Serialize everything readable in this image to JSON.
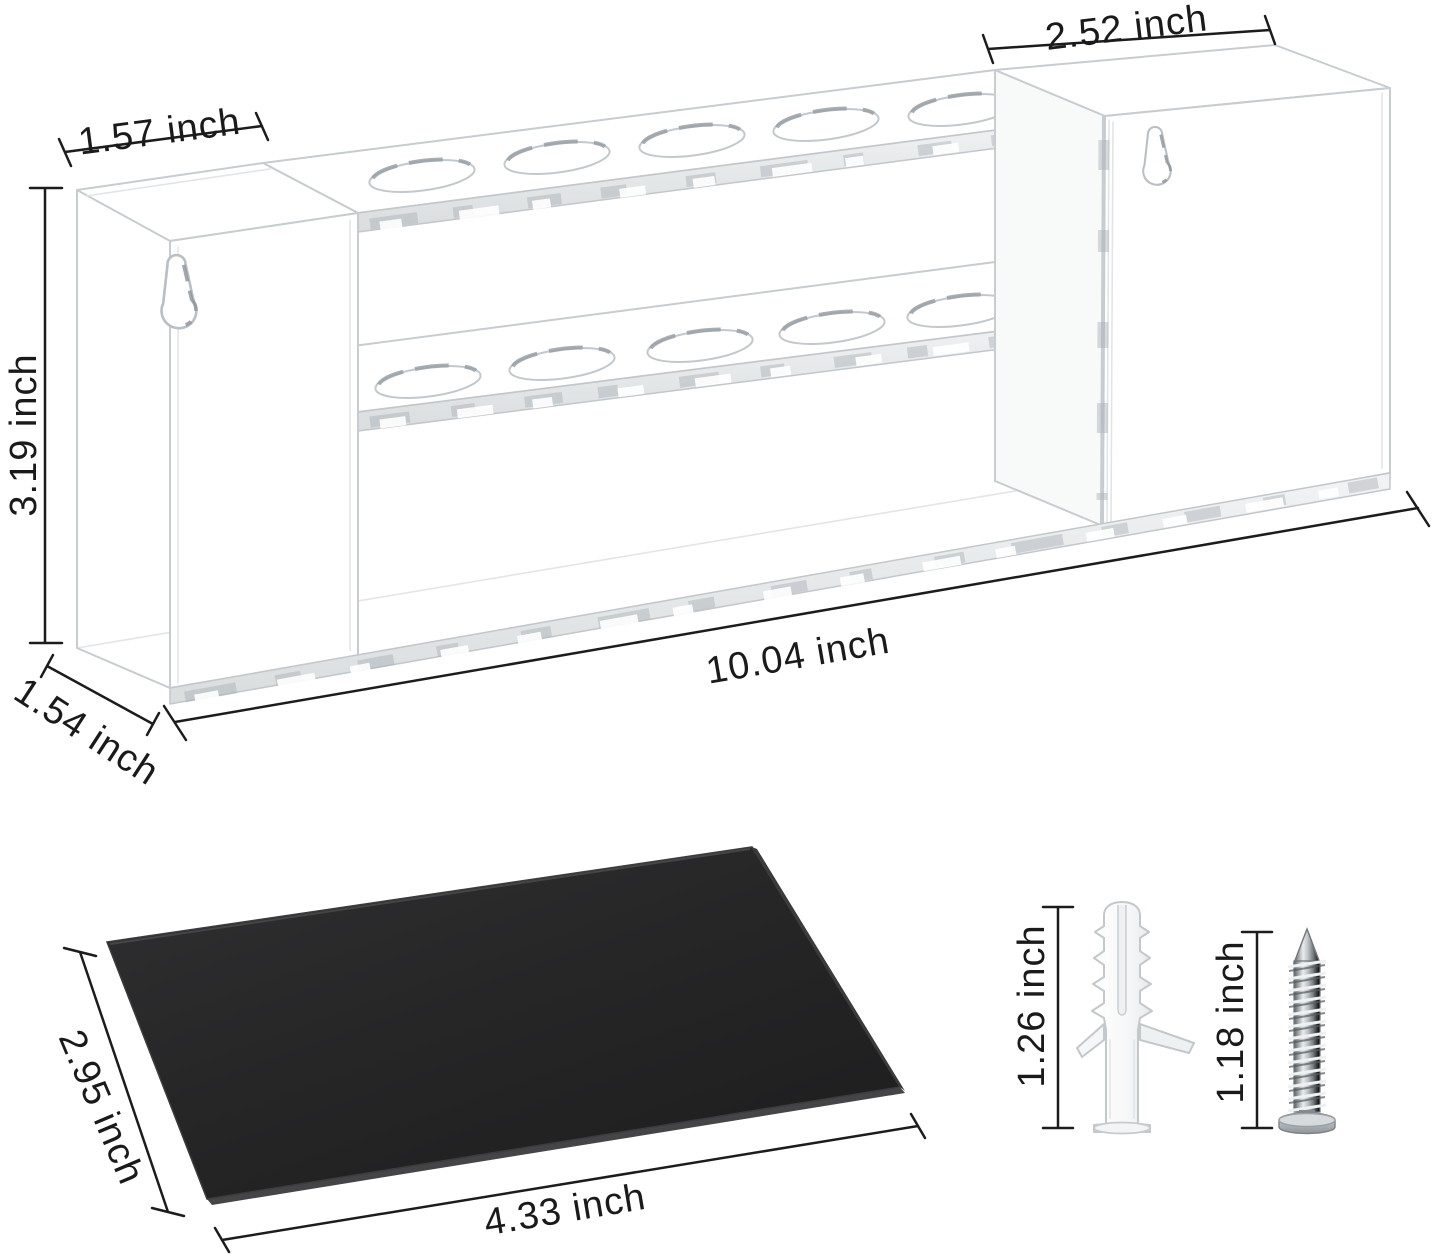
{
  "diagram": {
    "type": "product-dimension-drawing",
    "background_color": "#ffffff",
    "dimension_line_color": "#1c1c1c",
    "acrylic_edge_color": "#c7ccd0",
    "holder": {
      "top_row_holes": 5,
      "bottom_row_holes": 5,
      "keyholes": 2,
      "dims": {
        "left_section_width": "1.57 inch",
        "right_section_width": "2.52 inch",
        "height": "3.19 inch",
        "depth": "1.54 inch",
        "total_width": "10.04 inch"
      }
    },
    "mat": {
      "color": "#262626",
      "dims": {
        "depth": "2.95 inch",
        "width": "4.33 inch"
      }
    },
    "hardware": {
      "anchor": {
        "color": "#ffffff",
        "length": "1.26 inch"
      },
      "screw": {
        "color": "#9ba1a6",
        "length": "1.18 inch"
      }
    }
  }
}
